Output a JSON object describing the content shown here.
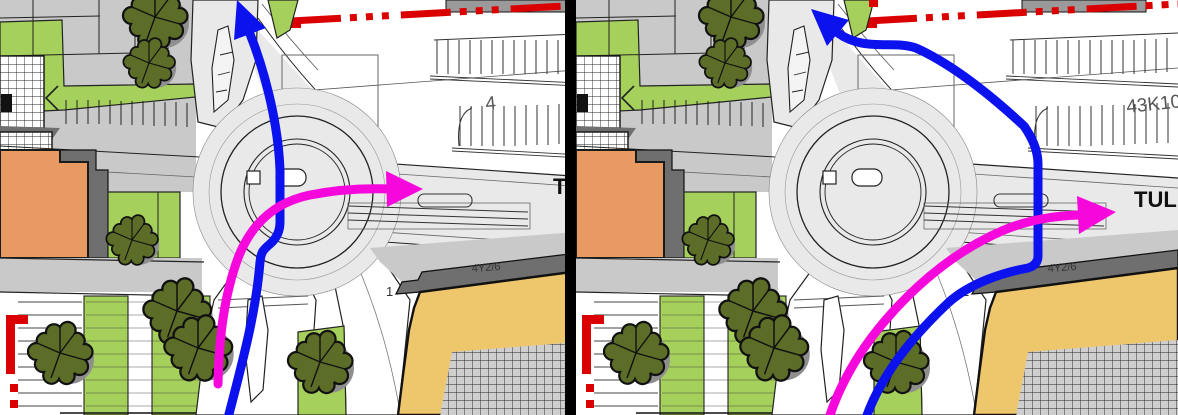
{
  "panels": [
    {
      "name": "variant-left",
      "street_label": "TULL",
      "parking_label": "4"
    },
    {
      "name": "variant-right",
      "street_label": "TULL",
      "parking_label": "43K10"
    }
  ],
  "shared_labels": {
    "block_label": "4Y2/6",
    "island_label": "1"
  },
  "colors": {
    "route_blue": "#0b12ee",
    "route_magenta": "#f608dc",
    "boundary_red": "#db0000",
    "grass": "#a6d05c",
    "tree": "#5c6d28",
    "tree_shadow": "#8f8f8f",
    "building_orange": "#e89a62",
    "building_yellow": "#eec76c",
    "road_gray": "#e9e9e9",
    "pavement_gray": "#c9c9c9",
    "shadow_gray": "#6f6f6f",
    "courtyard_gray": "#cfcfcf",
    "building_bar_gray": "#9a9a9a",
    "divider": "#000000"
  }
}
